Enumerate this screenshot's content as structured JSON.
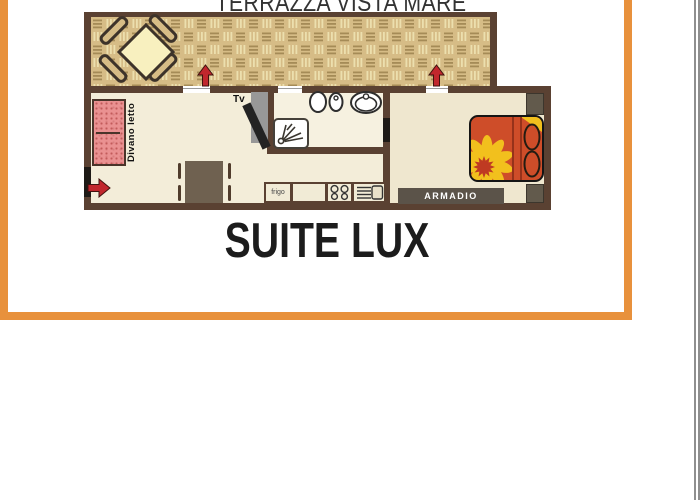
{
  "title": "TERRAZZA VISTA MARE",
  "caption": "SUITE LUX",
  "floorplan": {
    "labels": {
      "sofa_bed": "Divano letto",
      "tv": "Tv",
      "fridge": "frigo",
      "wardrobe": "ARMADIO"
    },
    "rooms": [
      "terrace",
      "living-room-with-kitchenette",
      "bathroom",
      "bedroom"
    ],
    "furniture_icons": [
      "terrace-table-with-4-chairs",
      "sofa-bed",
      "dining-table-with-chairs",
      "tv",
      "shower",
      "toilet",
      "bidet",
      "washbasin",
      "fridge",
      "stove",
      "kitchen-sink",
      "double-bed-with-sunflower",
      "nightstand",
      "wardrobe",
      "entrance-arrow",
      "terrace-door-arrows"
    ],
    "colors": {
      "frame_orange": "#e8913c",
      "wall_brown": "#5a4132",
      "floor_cream": "#f3edd9",
      "parquet_tan": "#d6bc86",
      "parquet_dash": "#a58b57",
      "parquet_light": "#ecdfae",
      "arrow_red": "#c1272d",
      "sofa_pink": "#ea9191",
      "bed_orange": "#ce4d29",
      "flower_yellow": "#f2c01d",
      "flower_center_red": "#bf3a22",
      "furniture_dark": "#5b5349",
      "terrace_table_cream": "#f8f0bf",
      "edge_line_gray": "#8f8f8f"
    }
  }
}
